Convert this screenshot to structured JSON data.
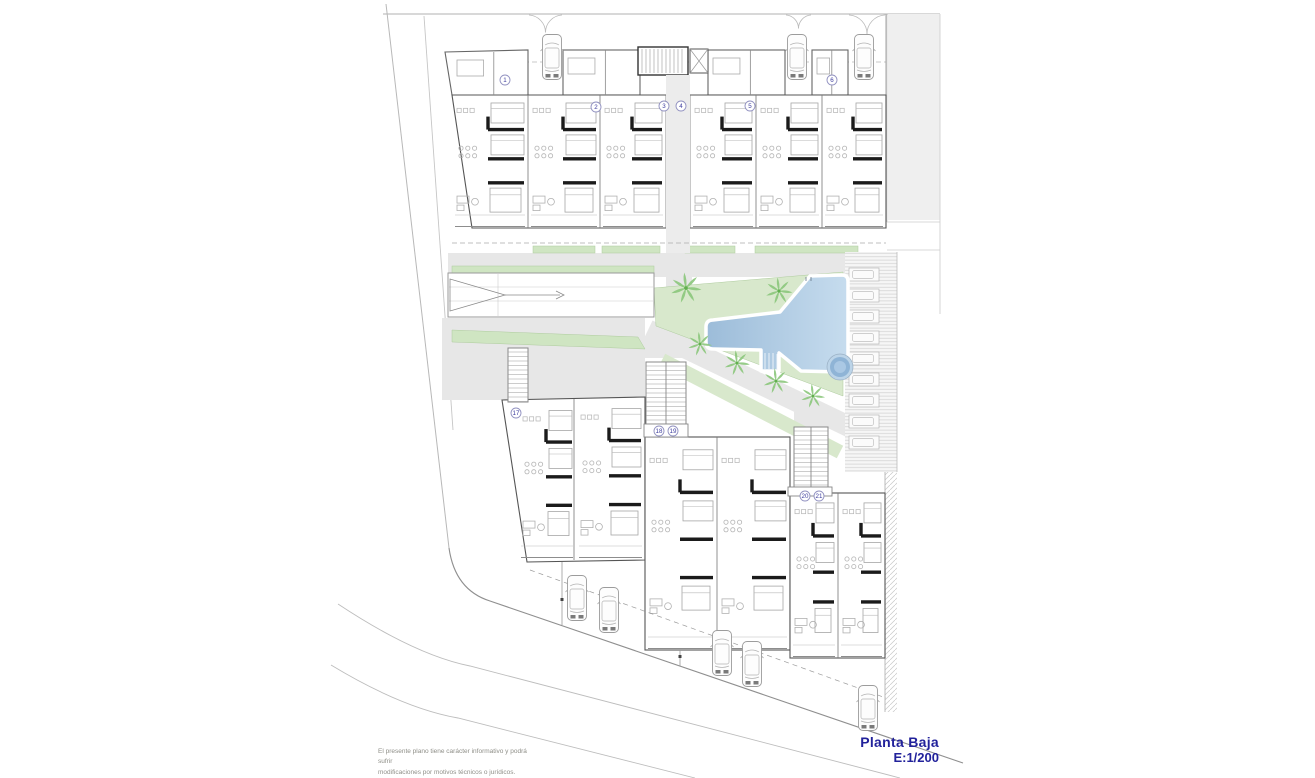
{
  "title_block": {
    "title": "Planta Baja",
    "scale": "E:1/200"
  },
  "disclaimer": {
    "line1": "El presente plano tiene carácter informativo y podrá sufrir",
    "line2": "modificaciones por motivos técnicos o jurídicos."
  },
  "top_units": [
    {
      "n": "1",
      "x": 505,
      "y": 80
    },
    {
      "n": "2",
      "x": 596,
      "y": 107
    },
    {
      "n": "3",
      "x": 664,
      "y": 106
    },
    {
      "n": "4",
      "x": 681,
      "y": 106
    },
    {
      "n": "5",
      "x": 750,
      "y": 106
    },
    {
      "n": "6",
      "x": 832,
      "y": 80
    }
  ],
  "lower_units": [
    {
      "n": "17",
      "x": 516,
      "y": 413
    },
    {
      "n": "18",
      "x": 659,
      "y": 431
    },
    {
      "n": "19",
      "x": 673,
      "y": 431
    },
    {
      "n": "20",
      "x": 805,
      "y": 496
    },
    {
      "n": "21",
      "x": 819,
      "y": 496
    }
  ],
  "cars": {
    "top": [
      {
        "x": 552,
        "y": 57
      },
      {
        "x": 797,
        "y": 57
      },
      {
        "x": 864,
        "y": 57
      }
    ],
    "bottom": [
      {
        "x": 577,
        "y": 598
      },
      {
        "x": 609,
        "y": 610
      },
      {
        "x": 722,
        "y": 653
      },
      {
        "x": 752,
        "y": 664
      },
      {
        "x": 868,
        "y": 708
      }
    ]
  },
  "palms": [
    {
      "x": 686,
      "y": 288,
      "s": 1.15
    },
    {
      "x": 779,
      "y": 291,
      "s": 1.0
    },
    {
      "x": 700,
      "y": 344,
      "s": 0.9
    },
    {
      "x": 737,
      "y": 363,
      "s": 0.95
    },
    {
      "x": 776,
      "y": 381,
      "s": 0.95
    },
    {
      "x": 813,
      "y": 396,
      "s": 0.9
    }
  ],
  "parking": {
    "stall_count": 9
  },
  "colors": {
    "title_blue": "#22229b",
    "pool_dark": "#9cbcd9",
    "pool_light": "#c6dcee",
    "spa_mid": "#8fb4d6",
    "garden_green": "#d8e8cc",
    "strip_green": "#cfe5c2",
    "palm_green": "#8bc77b",
    "path_gray": "#e7e7e7",
    "wall_dark": "#1b1b1b",
    "street_gray": "#bdbdbd"
  }
}
